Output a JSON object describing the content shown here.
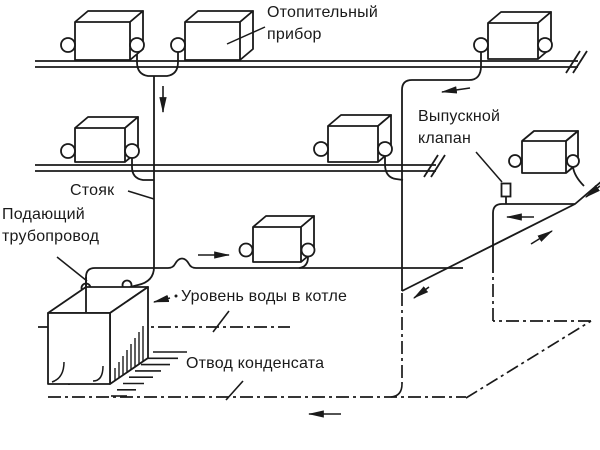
{
  "labels": {
    "heating_device": "Отопительный\nприбор",
    "release_valve": "Выпускной\nклапан",
    "riser": "Стояк",
    "supply_pipeline": "Подающий\nтрубопровод",
    "water_level_in_boiler": "Уровень воды в котле",
    "condensate_drain": "Отвод конденсата"
  },
  "colors": {
    "line": "#1a1a1a",
    "background": "#ffffff"
  }
}
